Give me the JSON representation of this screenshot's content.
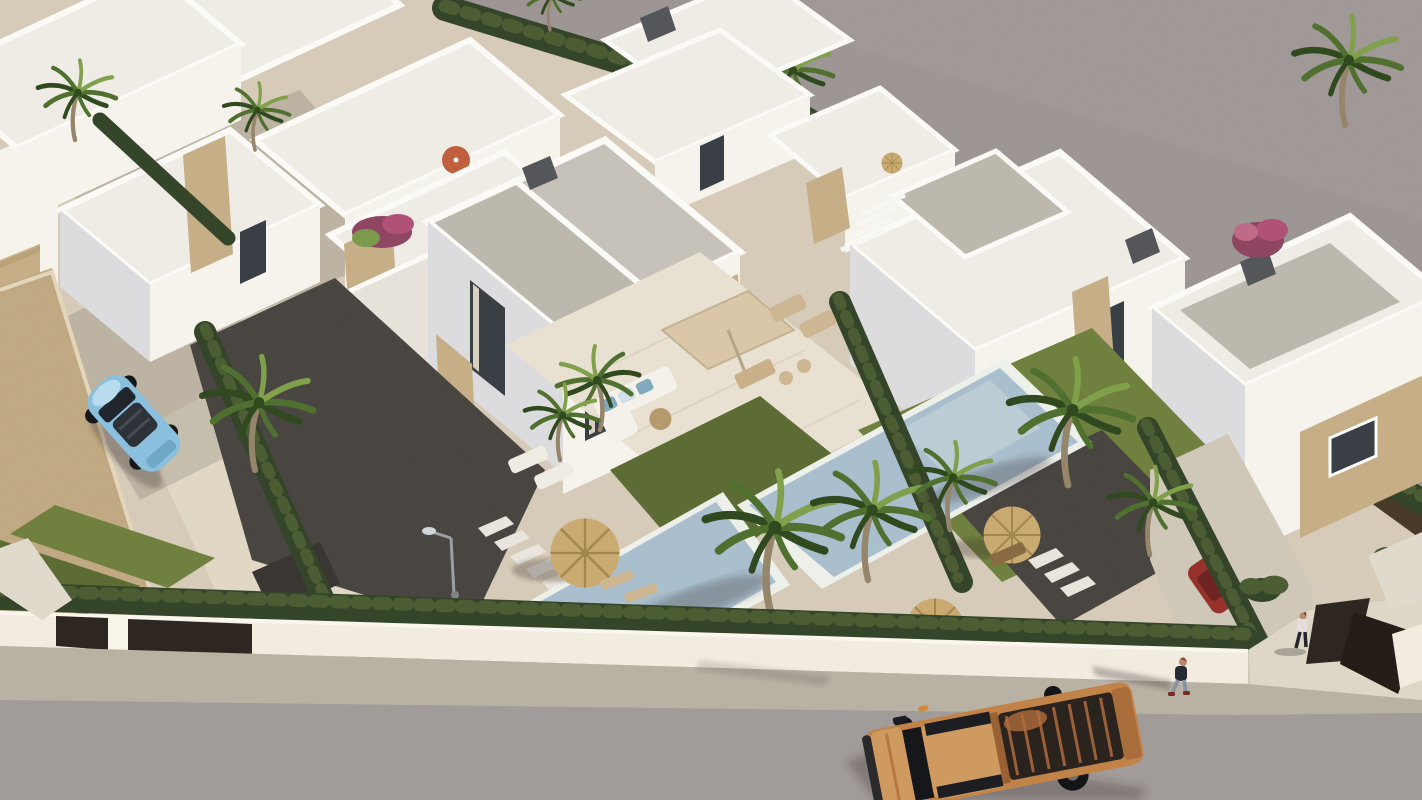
{
  "meta": {
    "title": "Aerial 3D architectural render of a white modern villa development with private pools, palm trees, hedged gardens and a street with an orange pickup truck"
  },
  "palette": {
    "upper-road": "#9a9391",
    "road": "#a39d9b",
    "sidewalk": "#b6afa0",
    "sand": "#d5cbb8",
    "sand-light": "#e4dbc9",
    "wall-white": "#f1ebe0",
    "wall-shade": "#e0dacc",
    "villa-white": "#f6f3ed",
    "villa-shade": "#dcdbdd",
    "roof-gray": "#bdb8ae",
    "roof-gray2": "#c7c2b9",
    "roof-light": "#efece6",
    "parapet": "#fbfaf6",
    "stone": "#c6ae86",
    "stone-dark": "#b0976f",
    "hedge-dark": "#35452a",
    "hedge-mid": "#4c5c33",
    "lawn": "#5d6b34",
    "lawn-light": "#70803f",
    "gravel": "#46423e",
    "gravel-light": "#59544e",
    "pool-water": "#a9bfce",
    "pool-shallow": "#c9d6db",
    "coping": "#edefe9",
    "deck": "#e8e0d1",
    "palm-dark": "#30491f",
    "palm-mid": "#50702f",
    "palm-light": "#81a04c",
    "trunk": "#95856a",
    "straw": "#c9aa70",
    "straw-dark": "#a3854f",
    "gate": "#2e2621",
    "fence-brown": "#4a3a2a",
    "truck-orange": "#c28348",
    "truck-hood": "#cf9a60",
    "truck-bed": "#2a231e",
    "truck-rib": "#9c6038",
    "car-blue": "#8ac0de",
    "car-red": "#96312c",
    "car-dark": "#3e4246",
    "parasol-orange": "#c05f3d",
    "cushion-blue": "#82aabf",
    "window-dark": "#3a3f45",
    "curtain": "#d9d0c0",
    "chimney": "#54565a",
    "shadow": "rgba(52,48,42,0.30)",
    "shadow-soft": "rgba(52,48,42,0.15)",
    "person-skin": "#b98a6d",
    "person-jeans": "#8a93a0",
    "person-dark": "#272a30",
    "person-pink": "#e7dcd8"
  },
  "scene": {
    "type": "aerial-3d-render",
    "objects": [
      "upper-access-road",
      "asphalt-street",
      "sidewalk",
      "white-perimeter-wall",
      "dark-entrance-gates",
      "white-modern-villas",
      "central-duplex-villa",
      "stone-accent-walls",
      "flat-gray-roofs",
      "private-pools",
      "lawns",
      "gravel-gardens",
      "boxwood-hedges",
      "palm-trees",
      "bougainvillea",
      "straw-parasols",
      "beige-terrace-parasol",
      "orange-parasol",
      "outdoor-sofa",
      "sun-loungers",
      "street-lamp",
      "stepping-stones",
      "orange-pickup-truck",
      "blue-convertible-car",
      "red-parked-car",
      "dark-parked-car",
      "pedestrian-on-sidewalk",
      "pedestrian-at-gate"
    ]
  }
}
